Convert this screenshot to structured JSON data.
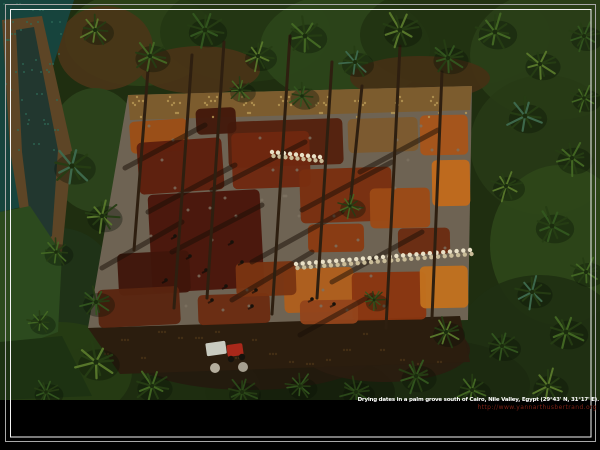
{
  "window": {
    "width": 600,
    "height": 450
  },
  "caption": {
    "line1": "Drying dates in a palm grove south of Cairo, Nile Valley, Egypt (29°43' N, 31°17' E).",
    "line2": "http://www.yannarthusbertrand.org",
    "line1_color": "#ffffff",
    "line2_color": "#7b2015"
  },
  "frame": {
    "background": "#000000",
    "outer": {
      "x": 5.5,
      "y": 4.5,
      "w": 590,
      "h": 437,
      "color": "#a9a9a9"
    },
    "inner": {
      "x": 10.5,
      "y": 9.5,
      "w": 580.5,
      "h": 427.5,
      "color": "#f4f4f4"
    }
  },
  "scene": {
    "photo_bottom": 400,
    "palette": {
      "foliage_base": "#1f2e10",
      "frond_dark": "#263d14",
      "frond_core": "#1b2c0e",
      "trunk": "#2e1f10",
      "shadow": "rgba(24,14,6,0.5)",
      "sack": "#e9e0c6",
      "sack_shade": "#c9bc98",
      "person": "#17110a",
      "tractor_red": "#a9281a",
      "tractor_cart": "#c9cbc0",
      "wheel": "#15120c",
      "pile": "#b5ae9d",
      "black_band": "#000000"
    },
    "foliage": [
      {
        "x": 140,
        "y": 38,
        "rx": 75,
        "ry": 48,
        "c": "#2d4218"
      },
      {
        "x": 245,
        "y": 32,
        "rx": 85,
        "ry": 50,
        "c": "#243713"
      },
      {
        "x": 345,
        "y": 48,
        "rx": 85,
        "ry": 55,
        "c": "#2c451a"
      },
      {
        "x": 455,
        "y": 35,
        "rx": 95,
        "ry": 52,
        "c": "#223311"
      },
      {
        "x": 555,
        "y": 55,
        "rx": 85,
        "ry": 65,
        "c": "#2a3f18"
      },
      {
        "x": 200,
        "y": 70,
        "rx": 60,
        "ry": 24,
        "c": "#4a3317"
      },
      {
        "x": 420,
        "y": 78,
        "rx": 70,
        "ry": 22,
        "c": "#443015"
      },
      {
        "x": 105,
        "y": 48,
        "rx": 48,
        "ry": 42,
        "c": "#4a3518"
      },
      {
        "x": 545,
        "y": 145,
        "rx": 75,
        "ry": 70,
        "c": "#273a16"
      },
      {
        "x": 560,
        "y": 245,
        "rx": 70,
        "ry": 80,
        "c": "#2e4619"
      },
      {
        "x": 540,
        "y": 345,
        "rx": 85,
        "ry": 70,
        "c": "#203012"
      },
      {
        "x": 95,
        "y": 150,
        "rx": 48,
        "ry": 62,
        "c": "#2c441c"
      },
      {
        "x": 60,
        "y": 290,
        "rx": 58,
        "ry": 62,
        "c": "#203318"
      },
      {
        "x": 435,
        "y": 385,
        "rx": 95,
        "ry": 45,
        "c": "#1c2a10"
      },
      {
        "x": 300,
        "y": 392,
        "rx": 95,
        "ry": 40,
        "c": "#16200c"
      },
      {
        "x": 165,
        "y": 388,
        "rx": 95,
        "ry": 45,
        "c": "#1e2e10"
      },
      {
        "x": 60,
        "y": 372,
        "rx": 72,
        "ry": 50,
        "c": "#263c14"
      },
      {
        "x": 250,
        "y": 352,
        "rx": 125,
        "ry": 38,
        "c": "#241a0e"
      },
      {
        "x": 385,
        "y": 350,
        "rx": 85,
        "ry": 32,
        "c": "#2a1c0f"
      }
    ],
    "polygons": [
      {
        "pts": "0,0 74,0 46,88 58,168 26,206 0,212",
        "c": "#17443d"
      },
      {
        "pts": "2,20 42,16 72,150 62,252 30,272 10,150",
        "c": "#5d4526"
      },
      {
        "pts": "16,30 34,27 58,150 52,236 34,250 22,152",
        "c": "#22372f"
      },
      {
        "pts": "0,212 30,206 62,254 58,332 20,346 0,342",
        "c": "#2c4a1e"
      },
      {
        "pts": "0,342 62,336 92,396 0,400",
        "c": "#1d3212"
      },
      {
        "pts": "128,95 472,86 468,320 88,328",
        "c": "#6e6353"
      },
      {
        "pts": "128,95 472,86 470,110 130,120",
        "c": "#7c5c2e"
      },
      {
        "pts": "88,328 460,316 470,362 120,374",
        "c": "#2b1d0e"
      }
    ],
    "patches": [
      {
        "x": 130,
        "y": 120,
        "w": 58,
        "h": 32,
        "r": -4,
        "c": "#9c4e16"
      },
      {
        "x": 138,
        "y": 140,
        "w": 85,
        "h": 52,
        "r": -4,
        "c": "#5e1e0c"
      },
      {
        "x": 228,
        "y": 120,
        "w": 115,
        "h": 46,
        "r": -2,
        "c": "#54200e"
      },
      {
        "x": 232,
        "y": 132,
        "w": 78,
        "h": 56,
        "r": -2,
        "c": "#6f2810"
      },
      {
        "x": 348,
        "y": 118,
        "w": 70,
        "h": 34,
        "r": -2,
        "c": "#7d5a2f"
      },
      {
        "x": 420,
        "y": 115,
        "w": 48,
        "h": 40,
        "r": -1,
        "c": "#a8541a"
      },
      {
        "x": 432,
        "y": 160,
        "w": 38,
        "h": 46,
        "r": -1,
        "c": "#c26a1c"
      },
      {
        "x": 196,
        "y": 108,
        "w": 40,
        "h": 26,
        "r": -3,
        "c": "#43190b"
      },
      {
        "x": 150,
        "y": 192,
        "w": 112,
        "h": 98,
        "r": -3,
        "c": "#4a150a"
      },
      {
        "x": 300,
        "y": 168,
        "w": 92,
        "h": 54,
        "r": -2,
        "c": "#7a2f10"
      },
      {
        "x": 370,
        "y": 188,
        "w": 60,
        "h": 40,
        "r": -1,
        "c": "#9c4a16"
      },
      {
        "x": 308,
        "y": 224,
        "w": 56,
        "h": 28,
        "r": -1,
        "c": "#8a3a12"
      },
      {
        "x": 398,
        "y": 228,
        "w": 52,
        "h": 26,
        "r": -1,
        "c": "#6b2c12"
      },
      {
        "x": 118,
        "y": 252,
        "w": 72,
        "h": 42,
        "r": -3,
        "c": "#40150a"
      },
      {
        "x": 284,
        "y": 268,
        "w": 70,
        "h": 44,
        "r": -2,
        "c": "#b05f1d"
      },
      {
        "x": 352,
        "y": 272,
        "w": 74,
        "h": 48,
        "r": -1,
        "c": "#8a3510"
      },
      {
        "x": 420,
        "y": 266,
        "w": 48,
        "h": 42,
        "r": -1,
        "c": "#c2701e"
      },
      {
        "x": 300,
        "y": 300,
        "w": 58,
        "h": 24,
        "r": -1,
        "c": "#93441b"
      },
      {
        "x": 98,
        "y": 288,
        "w": 82,
        "h": 38,
        "r": -3,
        "c": "#5a2410"
      },
      {
        "x": 198,
        "y": 294,
        "w": 72,
        "h": 30,
        "r": -2,
        "c": "#6b2c12"
      },
      {
        "x": 236,
        "y": 262,
        "w": 60,
        "h": 34,
        "r": -2,
        "c": "#7a3412"
      }
    ],
    "speckle_areas": [
      {
        "x": 4,
        "y": 4,
        "w": 58,
        "h": 150,
        "n": 50,
        "c": "#2e6b58",
        "r": 1
      },
      {
        "x": 132,
        "y": 96,
        "w": 335,
        "h": 22,
        "n": 60,
        "c": "#b99a55",
        "r": 1.2
      },
      {
        "x": 100,
        "y": 330,
        "w": 350,
        "h": 38,
        "n": 45,
        "c": "#4a3318",
        "r": 1.2
      },
      {
        "x": 140,
        "y": 125,
        "w": 320,
        "h": 190,
        "n": 40,
        "c": "#7d7261",
        "r": 1.5
      }
    ],
    "shadows": [
      {
        "x1": 205,
        "y1": 125,
        "x2": 125,
        "y2": 168
      },
      {
        "x1": 235,
        "y1": 165,
        "x2": 148,
        "y2": 212
      },
      {
        "x1": 262,
        "y1": 205,
        "x2": 172,
        "y2": 252
      },
      {
        "x1": 305,
        "y1": 142,
        "x2": 212,
        "y2": 190
      },
      {
        "x1": 342,
        "y1": 212,
        "x2": 252,
        "y2": 262
      },
      {
        "x1": 392,
        "y1": 162,
        "x2": 302,
        "y2": 210
      },
      {
        "x1": 422,
        "y1": 232,
        "x2": 332,
        "y2": 282
      },
      {
        "x1": 312,
        "y1": 252,
        "x2": 232,
        "y2": 300
      },
      {
        "x1": 182,
        "y1": 222,
        "x2": 102,
        "y2": 268
      },
      {
        "x1": 372,
        "y1": 295,
        "x2": 300,
        "y2": 335
      },
      {
        "x1": 438,
        "y1": 130,
        "x2": 360,
        "y2": 172
      }
    ],
    "trunks": [
      {
        "x1": 192,
        "y1": 55,
        "x2": 174,
        "y2": 308
      },
      {
        "x1": 224,
        "y1": 42,
        "x2": 207,
        "y2": 298
      },
      {
        "x1": 290,
        "y1": 36,
        "x2": 272,
        "y2": 314
      },
      {
        "x1": 332,
        "y1": 62,
        "x2": 317,
        "y2": 298
      },
      {
        "x1": 400,
        "y1": 46,
        "x2": 386,
        "y2": 328
      },
      {
        "x1": 442,
        "y1": 72,
        "x2": 432,
        "y2": 318
      },
      {
        "x1": 362,
        "y1": 86,
        "x2": 350,
        "y2": 206
      },
      {
        "x1": 148,
        "y1": 70,
        "x2": 134,
        "y2": 250
      }
    ],
    "sack_rows": [
      {
        "x1": 272,
        "y1": 152,
        "x2": 320,
        "y2": 157,
        "n": 9
      },
      {
        "x1": 296,
        "y1": 264,
        "x2": 470,
        "y2": 250,
        "n": 27
      }
    ],
    "people": [
      {
        "x": 175,
        "y": 236
      },
      {
        "x": 190,
        "y": 256
      },
      {
        "x": 206,
        "y": 270
      },
      {
        "x": 226,
        "y": 286
      },
      {
        "x": 242,
        "y": 262
      },
      {
        "x": 256,
        "y": 290
      },
      {
        "x": 232,
        "y": 242
      },
      {
        "x": 212,
        "y": 300
      },
      {
        "x": 252,
        "y": 306
      },
      {
        "x": 166,
        "y": 280
      },
      {
        "x": 312,
        "y": 299
      },
      {
        "x": 334,
        "y": 304
      }
    ],
    "palms": [
      {
        "x": 95,
        "y": 30,
        "s": 1.0,
        "c": "#5a7a2c"
      },
      {
        "x": 150,
        "y": 56,
        "s": 1.1,
        "c": "#446924"
      },
      {
        "x": 205,
        "y": 30,
        "s": 1.2,
        "c": "#33571f"
      },
      {
        "x": 258,
        "y": 56,
        "s": 1.0,
        "c": "#5a7a2c"
      },
      {
        "x": 305,
        "y": 36,
        "s": 1.2,
        "c": "#446924"
      },
      {
        "x": 355,
        "y": 62,
        "s": 1.0,
        "c": "#3f6b4f"
      },
      {
        "x": 400,
        "y": 30,
        "s": 1.2,
        "c": "#5a7a2c"
      },
      {
        "x": 448,
        "y": 58,
        "s": 1.1,
        "c": "#33571f"
      },
      {
        "x": 495,
        "y": 32,
        "s": 1.2,
        "c": "#446924"
      },
      {
        "x": 540,
        "y": 64,
        "s": 1.1,
        "c": "#5a7a2c"
      },
      {
        "x": 584,
        "y": 36,
        "s": 1.0,
        "c": "#33571f"
      },
      {
        "x": 584,
        "y": 98,
        "s": 0.9,
        "c": "#446924"
      },
      {
        "x": 525,
        "y": 116,
        "s": 1.2,
        "c": "#3f6b4f"
      },
      {
        "x": 572,
        "y": 158,
        "s": 1.1,
        "c": "#446924"
      },
      {
        "x": 506,
        "y": 186,
        "s": 1.0,
        "c": "#5a7a2c"
      },
      {
        "x": 552,
        "y": 226,
        "s": 1.2,
        "c": "#33571f"
      },
      {
        "x": 586,
        "y": 272,
        "s": 1.0,
        "c": "#446924"
      },
      {
        "x": 532,
        "y": 292,
        "s": 1.1,
        "c": "#3f6b4f"
      },
      {
        "x": 566,
        "y": 332,
        "s": 1.2,
        "c": "#446924"
      },
      {
        "x": 502,
        "y": 346,
        "s": 1.0,
        "c": "#33571f"
      },
      {
        "x": 548,
        "y": 386,
        "s": 1.1,
        "c": "#5a7a2c"
      },
      {
        "x": 472,
        "y": 390,
        "s": 1.0,
        "c": "#446924"
      },
      {
        "x": 416,
        "y": 376,
        "s": 1.1,
        "c": "#33571f"
      },
      {
        "x": 356,
        "y": 392,
        "s": 1.0,
        "c": "#2c4a1a"
      },
      {
        "x": 300,
        "y": 386,
        "s": 0.9,
        "c": "#33571f"
      },
      {
        "x": 242,
        "y": 392,
        "s": 1.0,
        "c": "#2c4a1a"
      },
      {
        "x": 152,
        "y": 386,
        "s": 1.1,
        "c": "#446924"
      },
      {
        "x": 96,
        "y": 362,
        "s": 1.3,
        "c": "#5a7a2c"
      },
      {
        "x": 46,
        "y": 392,
        "s": 0.9,
        "c": "#33571f"
      },
      {
        "x": 72,
        "y": 166,
        "s": 1.3,
        "c": "#3f6b4f"
      },
      {
        "x": 102,
        "y": 216,
        "s": 1.1,
        "c": "#5a7a2c"
      },
      {
        "x": 56,
        "y": 252,
        "s": 0.9,
        "c": "#446924"
      },
      {
        "x": 96,
        "y": 302,
        "s": 1.0,
        "c": "#33571f"
      },
      {
        "x": 40,
        "y": 322,
        "s": 0.8,
        "c": "#446924"
      },
      {
        "x": 350,
        "y": 206,
        "s": 0.8,
        "c": "#446924"
      },
      {
        "x": 374,
        "y": 300,
        "s": 0.7,
        "c": "#33571f"
      },
      {
        "x": 446,
        "y": 332,
        "s": 1.0,
        "c": "#5a7a2c"
      },
      {
        "x": 302,
        "y": 96,
        "s": 0.9,
        "c": "#33571f"
      },
      {
        "x": 240,
        "y": 90,
        "s": 0.8,
        "c": "#446924"
      }
    ],
    "tractor": {
      "x": 206,
      "y": 338
    }
  }
}
